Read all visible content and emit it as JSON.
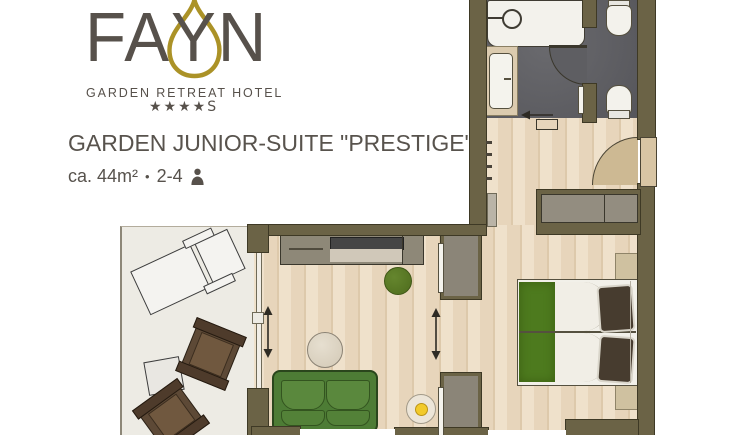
{
  "header": {
    "logo": {
      "word_pre": "FA",
      "drop_letter": "Y",
      "word_post": "N",
      "tagline": "GARDEN RETREAT HOTEL",
      "stars": "★★★★",
      "stars_suffix": "S"
    },
    "title": "GARDEN JUNIOR-SUITE \"PRESTIGE\"",
    "meta": {
      "area": "ca. 44m²",
      "separator": "•",
      "capacity": "2-4"
    }
  },
  "colors": {
    "wall": "#6b6346",
    "bath_floor": "#5e5e62",
    "balcony_floor": "#edebe4",
    "wood_light": "#efe1cb",
    "wood_mid": "#e7d5bb",
    "wood_dark": "#ddc9ab",
    "furniture_gray": "#8e8878",
    "tv_dark": "#454545",
    "sofa_green": "#4d7c35",
    "bed_green": "#4d7a1e",
    "pillow_brown": "#473c2f",
    "lamp_yellow": "#f2ca2b",
    "plant_green": "#5a7a24",
    "door_tan": "#cdb993",
    "chair_brown": "#5d4936",
    "brand_gold": "#ab9227",
    "text_gray": "#57514b"
  }
}
